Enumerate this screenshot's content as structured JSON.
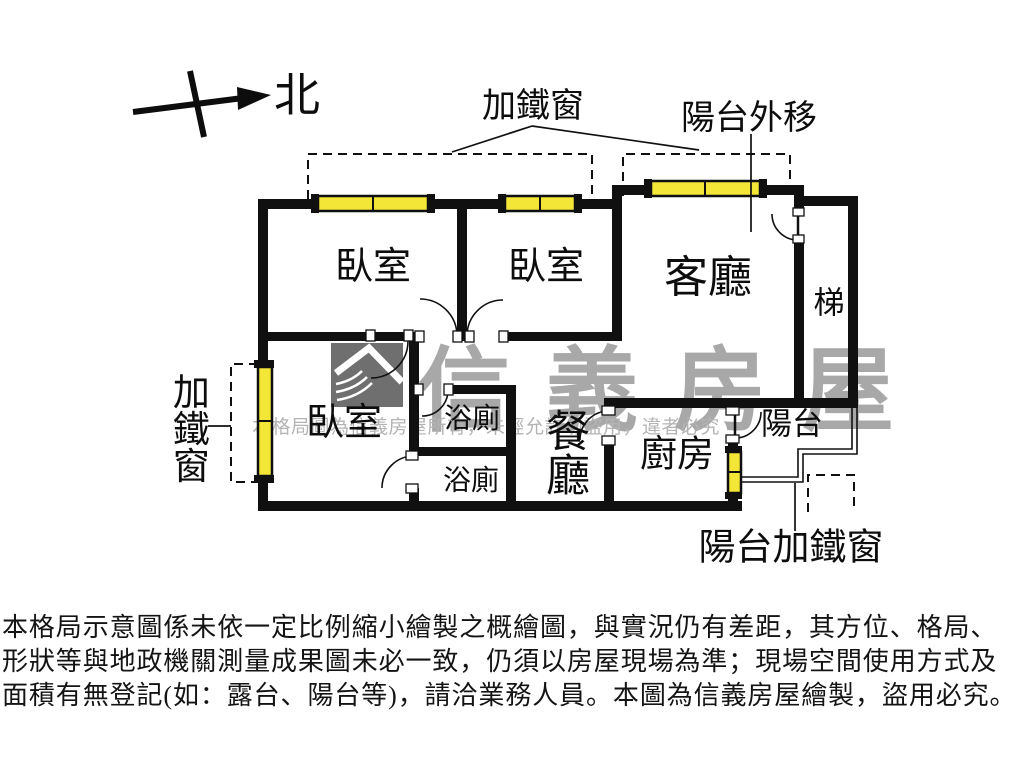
{
  "compass": {
    "label": "北"
  },
  "annotations": {
    "top_iron_window": "加鐵窗",
    "balcony_extended": "陽台外移",
    "side_iron_window": "加鐵窗",
    "balcony_iron_window": "陽台加鐵窗"
  },
  "rooms": {
    "bedroom_top_left": "臥室",
    "bedroom_top_mid": "臥室",
    "living_room": "客廳",
    "stairs": "梯",
    "bedroom_bottom_left": "臥室",
    "bathroom_upper": "浴廁",
    "bathroom_lower": "浴廁",
    "dining_room": "餐廳",
    "kitchen": "廚房",
    "balcony": "陽台"
  },
  "watermark": {
    "brand": "信義房屋",
    "notice": "本格局圖為信義房屋所有，未經允許勿盜用，違者必究"
  },
  "disclaimer": {
    "line1": "本格局示意圖係未依一定比例縮小繪製之概繪圖，與實況仍有差距，其方位、格局、",
    "line2": "形狀等與地政機關測量成果圖未必一致，仍須以房屋現場為準；現場空間使用方式及",
    "line3": "面積有無登記(如：露台、陽台等)，請洽業務人員。本圖為信義房屋繪製，盜用必究。"
  },
  "colors": {
    "wall": "#101010",
    "window_glass": "#f3e637",
    "watermark_gray": "#a8a8a8"
  }
}
